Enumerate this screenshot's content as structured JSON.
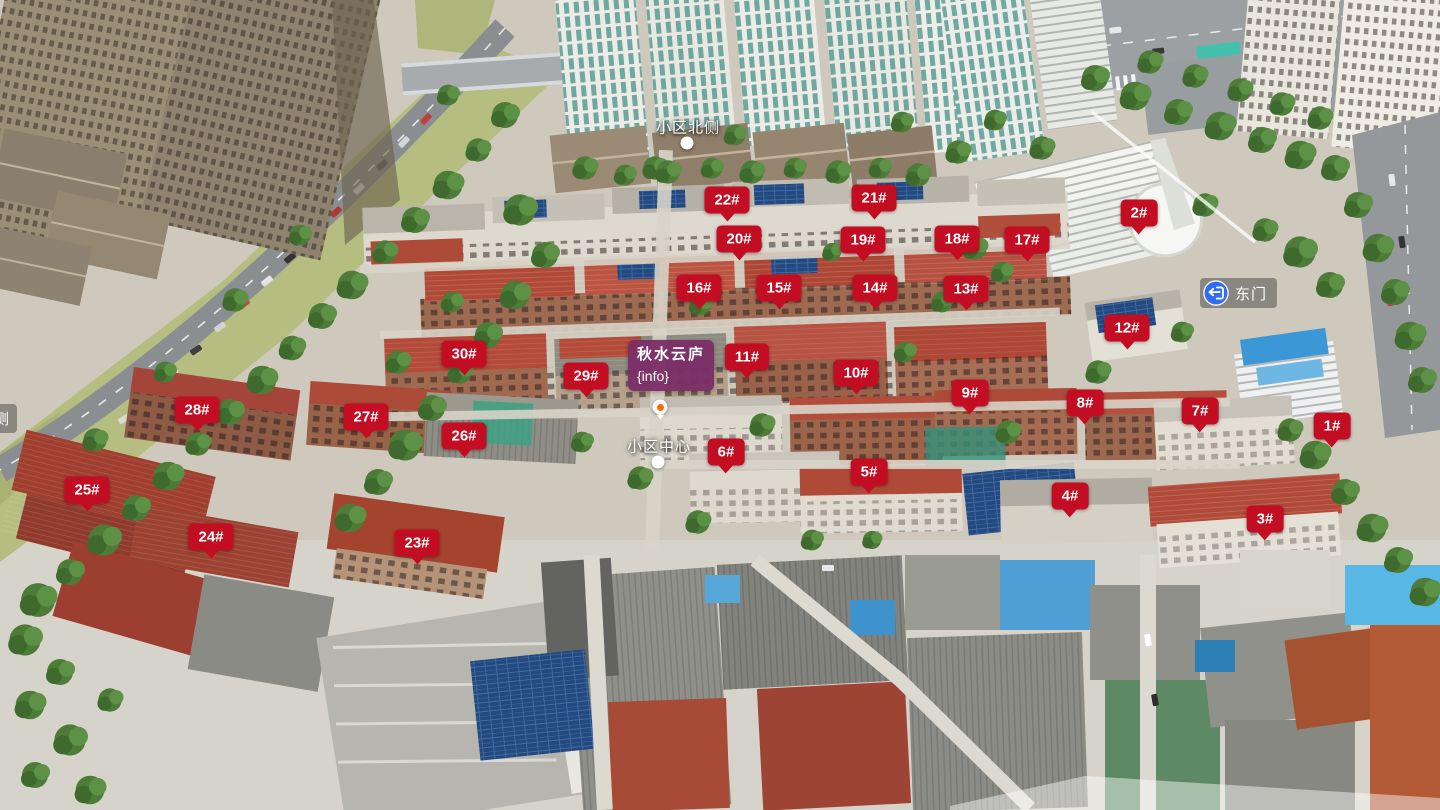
{
  "scene": {
    "name": "秋水云庐小区航拍全景"
  },
  "project": {
    "name": "秋水云庐",
    "info": "{info}",
    "x": 628,
    "y": 340,
    "pin_x": 660,
    "pin_y": 407
  },
  "pois": {
    "north": {
      "label": "小区北侧",
      "x": 688,
      "y": 127,
      "dot_x": 687,
      "dot_y": 143
    },
    "center": {
      "label": "小区中心",
      "x": 659,
      "y": 446,
      "dot_x": 658,
      "dot_y": 462
    },
    "east_gate": {
      "label": "东门",
      "x": 1200,
      "y": 278
    },
    "west_edge": {
      "label": "侧",
      "x": -14,
      "y": 404
    }
  },
  "markers": [
    {
      "label": "1#",
      "x": 1332,
      "y": 426
    },
    {
      "label": "2#",
      "x": 1139,
      "y": 213
    },
    {
      "label": "3#",
      "x": 1265,
      "y": 519
    },
    {
      "label": "4#",
      "x": 1070,
      "y": 496
    },
    {
      "label": "5#",
      "x": 869,
      "y": 472
    },
    {
      "label": "6#",
      "x": 726,
      "y": 452
    },
    {
      "label": "7#",
      "x": 1200,
      "y": 411
    },
    {
      "label": "8#",
      "x": 1085,
      "y": 403
    },
    {
      "label": "9#",
      "x": 970,
      "y": 393
    },
    {
      "label": "10#",
      "x": 856,
      "y": 373
    },
    {
      "label": "11#",
      "x": 747,
      "y": 357
    },
    {
      "label": "12#",
      "x": 1127,
      "y": 328
    },
    {
      "label": "13#",
      "x": 966,
      "y": 289
    },
    {
      "label": "14#",
      "x": 875,
      "y": 288
    },
    {
      "label": "15#",
      "x": 779,
      "y": 288
    },
    {
      "label": "16#",
      "x": 699,
      "y": 288
    },
    {
      "label": "17#",
      "x": 1027,
      "y": 240
    },
    {
      "label": "18#",
      "x": 957,
      "y": 239
    },
    {
      "label": "19#",
      "x": 863,
      "y": 240
    },
    {
      "label": "20#",
      "x": 739,
      "y": 239
    },
    {
      "label": "21#",
      "x": 874,
      "y": 198
    },
    {
      "label": "22#",
      "x": 727,
      "y": 200
    },
    {
      "label": "23#",
      "x": 417,
      "y": 543
    },
    {
      "label": "24#",
      "x": 211,
      "y": 537
    },
    {
      "label": "25#",
      "x": 87,
      "y": 490
    },
    {
      "label": "26#",
      "x": 464,
      "y": 436
    },
    {
      "label": "27#",
      "x": 366,
      "y": 417
    },
    {
      "label": "28#",
      "x": 197,
      "y": 410
    },
    {
      "label": "29#",
      "x": 586,
      "y": 376
    },
    {
      "label": "30#",
      "x": 464,
      "y": 354
    }
  ],
  "colors": {
    "marker_bg": "#c30d23",
    "project_bg": "rgba(123,45,102,0.95)",
    "gate_bg": "rgba(70,70,70,0.5)",
    "gate_icon": "#2f6df2",
    "river": "#b6bd80"
  }
}
